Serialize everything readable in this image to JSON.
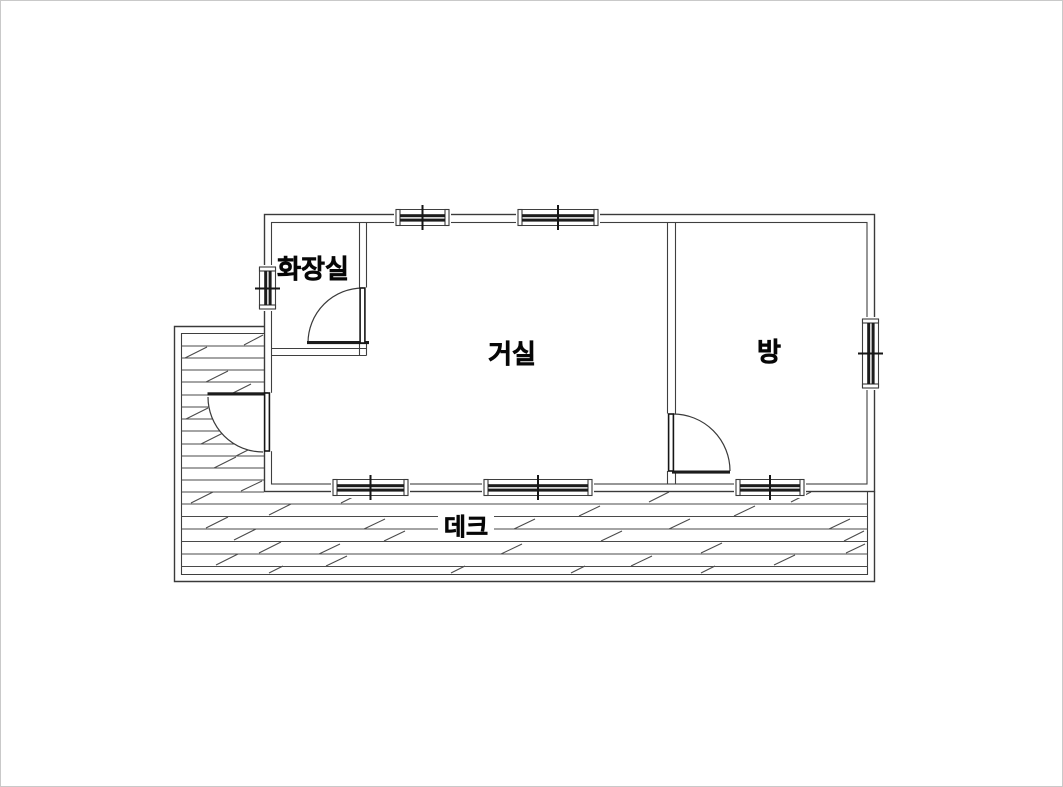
{
  "canvas": {
    "background": "#ffffff",
    "frame_color": "#c9c9c9"
  },
  "palette": {
    "wall_line": "#3a3a3a",
    "plank_line": "#4a4a4a",
    "fixture_dark": "#1c1c1c",
    "text_color": "#070707"
  },
  "rooms": {
    "bathroom": {
      "label": "화장실"
    },
    "living_room": {
      "label": "거실"
    },
    "bedroom": {
      "label": "방"
    },
    "deck": {
      "label": "데크"
    }
  }
}
